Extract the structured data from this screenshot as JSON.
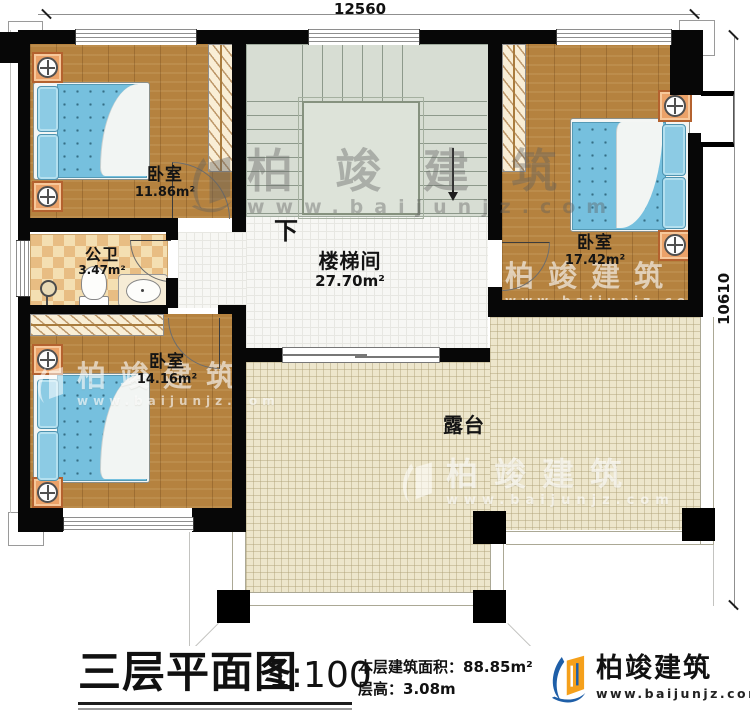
{
  "plan": {
    "dimensions": {
      "width_mm": "12560",
      "height_mm": "10610"
    },
    "rooms": {
      "bedroom_a": {
        "name": "卧室",
        "area": "11.86m²"
      },
      "bedroom_b": {
        "name": "卧室",
        "area": "17.42m²"
      },
      "bedroom_c": {
        "name": "卧室",
        "area": "14.16m²"
      },
      "bathroom": {
        "name": "公卫",
        "area": "3.47m²"
      },
      "stairwell": {
        "name": "楼梯间",
        "area": "27.70m²"
      },
      "terrace": {
        "name": "露台"
      },
      "stairs": {
        "down_label": "下"
      }
    }
  },
  "title_block": {
    "plan_title": "三层平面图",
    "scale": "1:100",
    "area_label": "本层建筑面积：",
    "area_value": "88.85m²",
    "height_label": "层高：",
    "height_value": "3.08m"
  },
  "brand": {
    "name": "柏竣建筑",
    "website": "www.baijunjz.com"
  },
  "watermark": {
    "name": "柏竣建筑",
    "website": "www.baijunjz.com"
  },
  "colors": {
    "wall": "#070707",
    "wood_floor": "#b5823f",
    "mattress_blue": "#76c0de",
    "stair_gray_green": "#d7ddd3",
    "terrace_tile": "#ede6cc",
    "bath_tile_orange": "#e8bd83",
    "brand_blue": "#1f5fa8",
    "brand_orange": "#f5a01b"
  }
}
